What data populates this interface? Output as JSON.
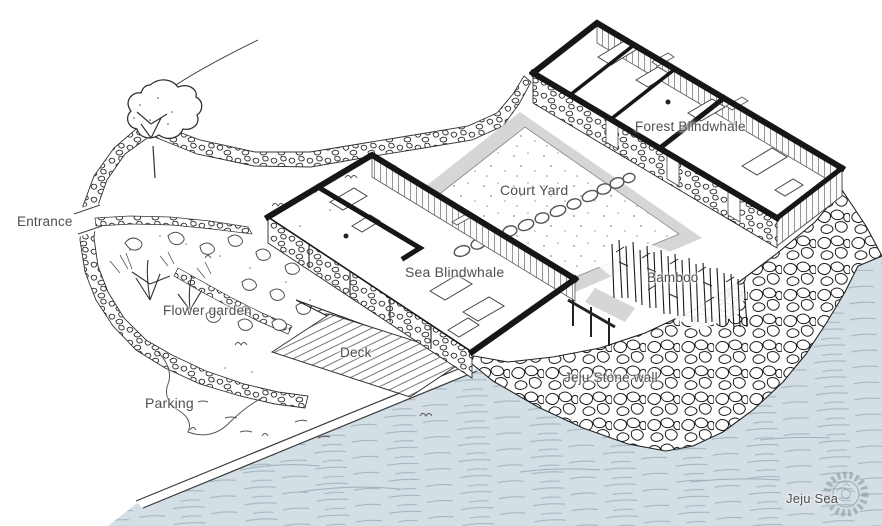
{
  "drawing": {
    "labels": {
      "entrance": "Entrance",
      "flower_garden": "Flower garden",
      "parking": "Parking",
      "deck": "Deck",
      "sea_blindwhale": "Sea Blindwhale",
      "court_yard": "Court Yard",
      "forest_blindwhale": "Forest Blindwhale",
      "bamboo": "Bamboo",
      "jeju_stone_wall": "Jeju Stone wall",
      "jeju_sea": "Jeju Sea"
    },
    "colors": {
      "sea_fill": "#d3dee5",
      "path_fill": "#d6d6d6",
      "ink": "#1f1f1f",
      "label_text": "#4e4f53",
      "watermark": "#8f979c"
    },
    "icons": {
      "watermark": "gear-stamp-icon"
    }
  }
}
